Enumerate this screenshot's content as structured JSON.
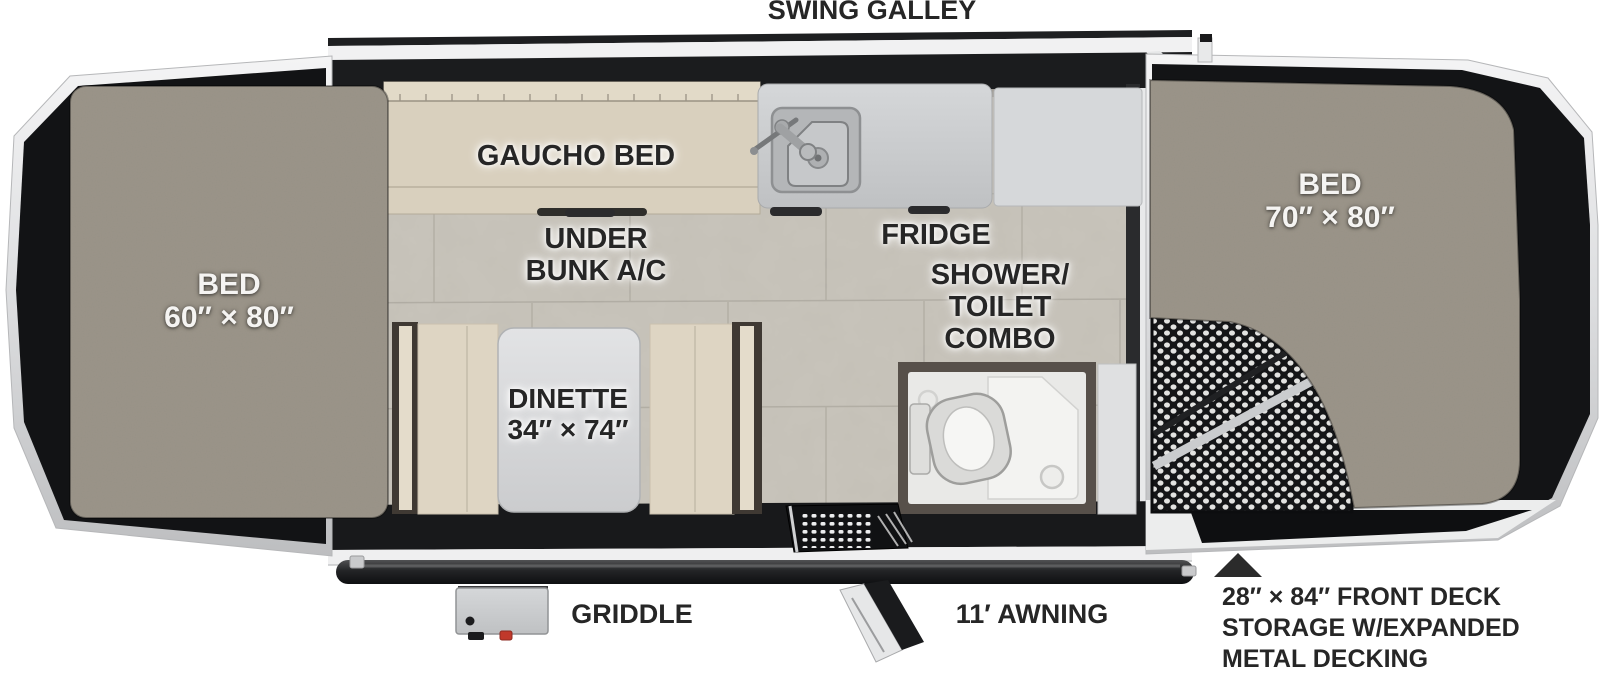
{
  "floorplan": {
    "galley_label": "SWING GALLEY",
    "areas": {
      "left_bed": {
        "name": "BED",
        "size": "60″ × 80″"
      },
      "right_bed": {
        "name": "BED",
        "size": "70″ × 80″"
      },
      "gaucho_bed": {
        "name": "GAUCHO BED"
      },
      "under_bunk_ac": {
        "line1": "UNDER",
        "line2": "BUNK A/C"
      },
      "fridge": {
        "name": "FRIDGE"
      },
      "shower_toilet_combo": {
        "line1": "SHOWER/",
        "line2": "TOILET",
        "line3": "COMBO"
      },
      "dinette": {
        "name": "DINETTE",
        "size": "34″ × 74″"
      }
    },
    "exterior": {
      "griddle": "GRIDDLE",
      "awning": "11′ AWNING",
      "front_deck": {
        "line1": "28″ × 84″ FRONT DECK",
        "line2": "STORAGE W/EXPANDED",
        "line3": "METAL DECKING"
      }
    },
    "colors": {
      "label_text": "#262626",
      "bed_fabric": "#8d8779",
      "floor_tile": "#c8c4bb",
      "upholstery": "#ddd4c2",
      "counter": "#cdcfd1",
      "trailer_black": "#1b1c1e",
      "frame_silver": "#e2e3e5",
      "accent_red": "#c0392b"
    }
  }
}
